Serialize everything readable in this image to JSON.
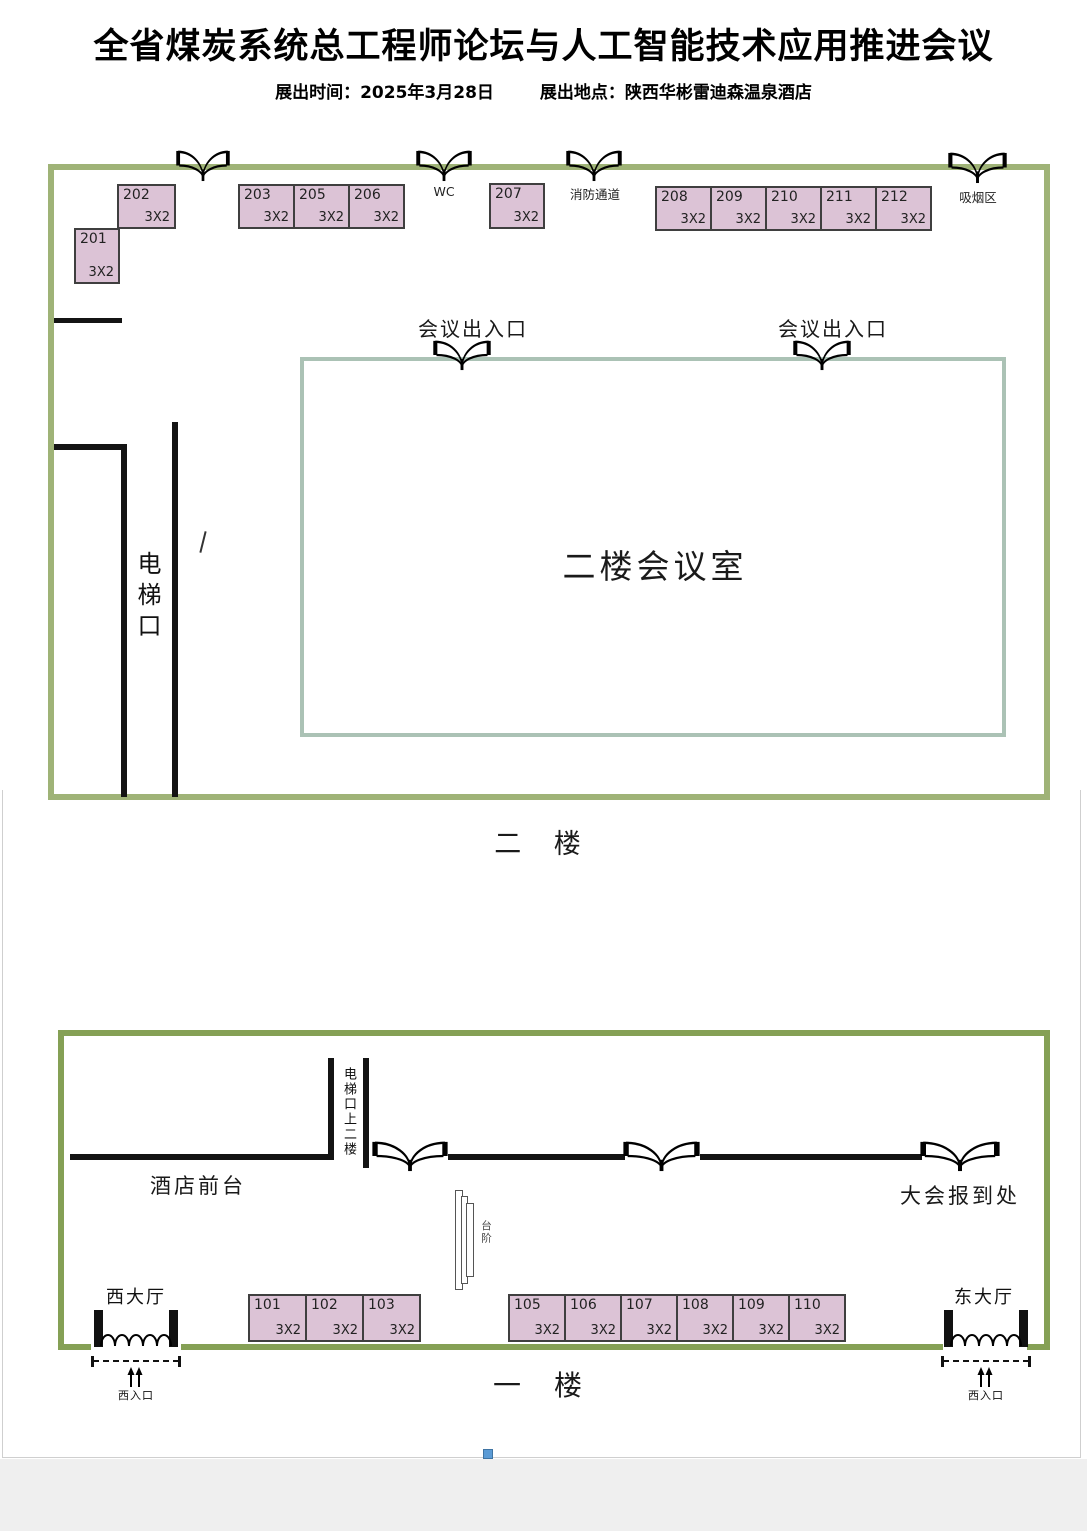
{
  "header": {
    "title": "全省煤炭系统总工程师论坛与人工智能技术应用推进会议",
    "date": "展出时间：2025年3月28日",
    "venue": "展出地点：陕西华彬雷迪森温泉酒店"
  },
  "floor2": {
    "label": "二 楼",
    "room_label": "二楼会议室",
    "elevator_label": "电梯口",
    "wc_label": "WC",
    "fire_exit_label": "消防通道",
    "smoking_label": "吸烟区",
    "entrance_labels": [
      "会议出入口",
      "会议出入口"
    ],
    "booths": [
      {
        "id": "201",
        "size": "3X2"
      },
      {
        "id": "202",
        "size": "3X2"
      },
      {
        "id": "203",
        "size": "3X2"
      },
      {
        "id": "205",
        "size": "3X2"
      },
      {
        "id": "206",
        "size": "3X2"
      },
      {
        "id": "207",
        "size": "3X2"
      },
      {
        "id": "208",
        "size": "3X2"
      },
      {
        "id": "209",
        "size": "3X2"
      },
      {
        "id": "210",
        "size": "3X2"
      },
      {
        "id": "211",
        "size": "3X2"
      },
      {
        "id": "212",
        "size": "3X2"
      }
    ]
  },
  "floor1": {
    "label": "一 楼",
    "front_desk_label": "酒店前台",
    "elevator_label": "电梯口上二楼",
    "registration_label": "大会报到处",
    "stairs_label": "台阶",
    "west_hall_label": "西大厅",
    "east_hall_label": "东大厅",
    "west_entrance_label": "西入口",
    "east_entrance_label": "西入口",
    "booths": [
      {
        "id": "101",
        "size": "3X2"
      },
      {
        "id": "102",
        "size": "3X2"
      },
      {
        "id": "103",
        "size": "3X2"
      },
      {
        "id": "105",
        "size": "3X2"
      },
      {
        "id": "106",
        "size": "3X2"
      },
      {
        "id": "107",
        "size": "3X2"
      },
      {
        "id": "108",
        "size": "3X2"
      },
      {
        "id": "109",
        "size": "3X2"
      },
      {
        "id": "110",
        "size": "3X2"
      }
    ]
  },
  "colors": {
    "plan2_border": "#9fb377",
    "plan1_border": "#85a055",
    "room_border": "#abc2b5",
    "booth_fill": "#dcc3d6",
    "booth_border": "#3f3f3f",
    "wall": "#141414",
    "handle_blue": "#5b9bd5"
  }
}
